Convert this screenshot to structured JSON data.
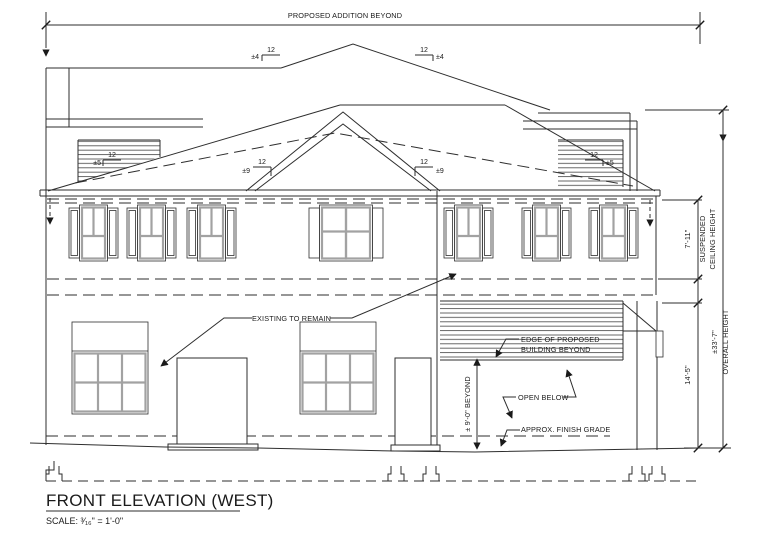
{
  "sheet": {
    "proposed_addition_label": "PROPOSED ADDITION BEYOND",
    "title": "FRONT ELEVATION (WEST)",
    "scale_note": "SCALE: ³⁄₁₆\" = 1'-0\""
  },
  "slopes": {
    "rise": "12",
    "addition_pitch": "±4",
    "gable_pitch": "±9",
    "clerestory_pitch": "±5"
  },
  "annotations": {
    "existing_to_remain": "EXISTING TO REMAIN",
    "edge_of_proposed_line1": "EDGE OF PROPOSED",
    "edge_of_proposed_line2": "BUILDING BEYOND",
    "open_below": "OPEN BELOW",
    "approx_finish_grade": "APPROX. FINISH GRADE",
    "beyond_height": "± 9'-0\" BEYOND"
  },
  "dimensions": {
    "suspended_ceiling_height": "7'-11\"",
    "suspended_ceiling_label_line1": "SUSPENDED",
    "suspended_ceiling_label_line2": "CEILING HEIGHT",
    "first_floor_height": "14'-5\"",
    "overall_height": "±33'-7\"",
    "overall_height_label": "OVERALL HEIGHT"
  },
  "colors": {
    "line": "#2e2e2e",
    "text": "#1a1a1a",
    "sash": "#a2a2a2",
    "paper": "#ffffff"
  }
}
